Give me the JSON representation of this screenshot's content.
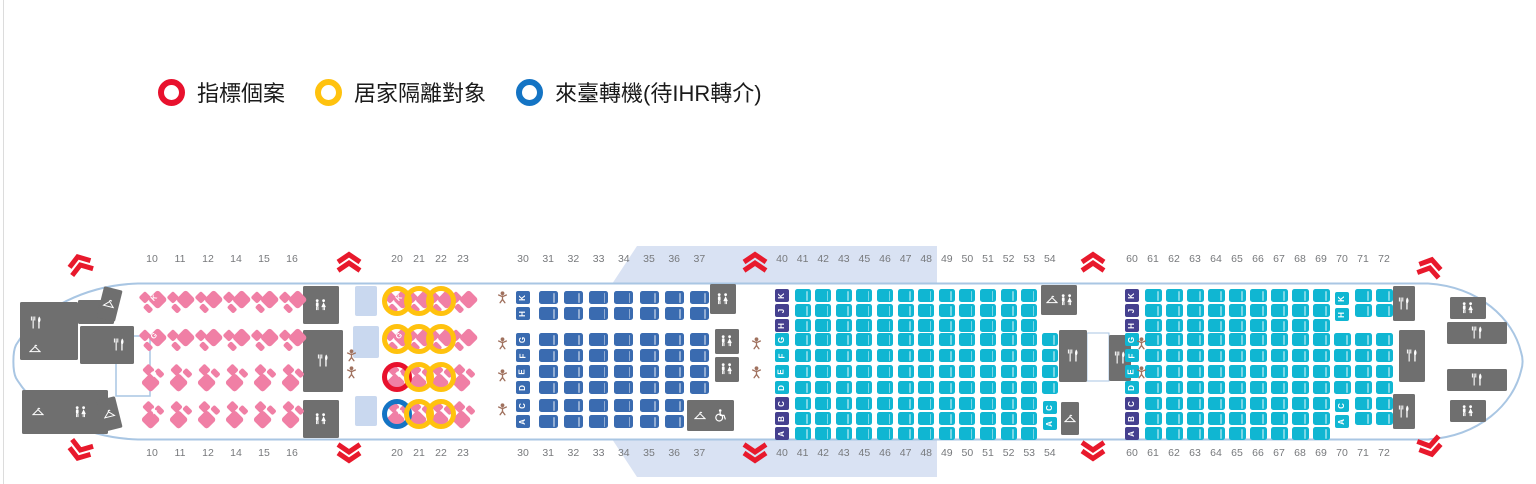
{
  "legend": {
    "items": [
      {
        "key": "index",
        "label": "指標個案",
        "color": "#e8112d"
      },
      {
        "key": "quarantine",
        "label": "居家隔離對象",
        "color": "#ffc20e"
      },
      {
        "key": "transit",
        "label": "來臺轉機(待IHR轉介)",
        "color": "#1474c4"
      }
    ]
  },
  "seatmap": {
    "sections": {
      "business_front": {
        "rows": [
          "10",
          "11",
          "12",
          "14",
          "15",
          "16"
        ]
      },
      "business_rear": {
        "rows": [
          "20",
          "21",
          "22",
          "23"
        ]
      },
      "economy_front": {
        "rows": [
          "30",
          "31",
          "32",
          "33",
          "34",
          "35",
          "36",
          "37"
        ]
      },
      "economy_mid": {
        "rows": [
          "40",
          "41",
          "42",
          "43",
          "45",
          "46",
          "47",
          "48",
          "49",
          "50",
          "51",
          "52",
          "53",
          "54"
        ]
      },
      "economy_rear": {
        "rows": [
          "60",
          "61",
          "62",
          "63",
          "64",
          "65",
          "66",
          "67",
          "68",
          "69",
          "70",
          "71",
          "72"
        ]
      }
    },
    "business_line_letters": [
      "K",
      "G",
      "D",
      "A"
    ],
    "letter_groups": {
      "top3": [
        "K",
        "J",
        "H"
      ],
      "top2": [
        "K",
        "H"
      ],
      "mid4": [
        "G",
        "F",
        "E",
        "D"
      ],
      "bottom3": [
        "C",
        "B",
        "A"
      ],
      "bottom2": [
        "C",
        "A"
      ]
    },
    "statuses": {
      "index": {
        "label": "指標個案",
        "color": "#e8112d"
      },
      "quarantine": {
        "label": "居家隔離對象",
        "color": "#ffc20e"
      },
      "transit": {
        "label": "來臺轉機(待IHR轉介)",
        "color": "#1474c4"
      }
    },
    "marks": [
      {
        "seat": "20K",
        "status": "quarantine"
      },
      {
        "seat": "21K",
        "status": "quarantine"
      },
      {
        "seat": "22K",
        "status": "quarantine"
      },
      {
        "seat": "20G",
        "status": "quarantine"
      },
      {
        "seat": "21G",
        "status": "quarantine"
      },
      {
        "seat": "22G",
        "status": "quarantine"
      },
      {
        "seat": "20D",
        "status": "index"
      },
      {
        "seat": "21D",
        "status": "quarantine"
      },
      {
        "seat": "22D",
        "status": "quarantine"
      },
      {
        "seat": "20A",
        "status": "transit"
      },
      {
        "seat": "21A",
        "status": "quarantine"
      },
      {
        "seat": "22A",
        "status": "quarantine"
      }
    ],
    "colors": {
      "business": "#f07fa5",
      "economy": "#3a6bb0",
      "premium_teal": "#10b6d2",
      "letter_purple": "#45408f",
      "facility": "#6f6f6f",
      "wing": "#d9e2f3",
      "hull": "#a9c6e3",
      "exit": "#e8192c",
      "bassinet": "#a0715e",
      "wardrobe": "#c9d8ef",
      "row_number": "#77797c"
    }
  }
}
